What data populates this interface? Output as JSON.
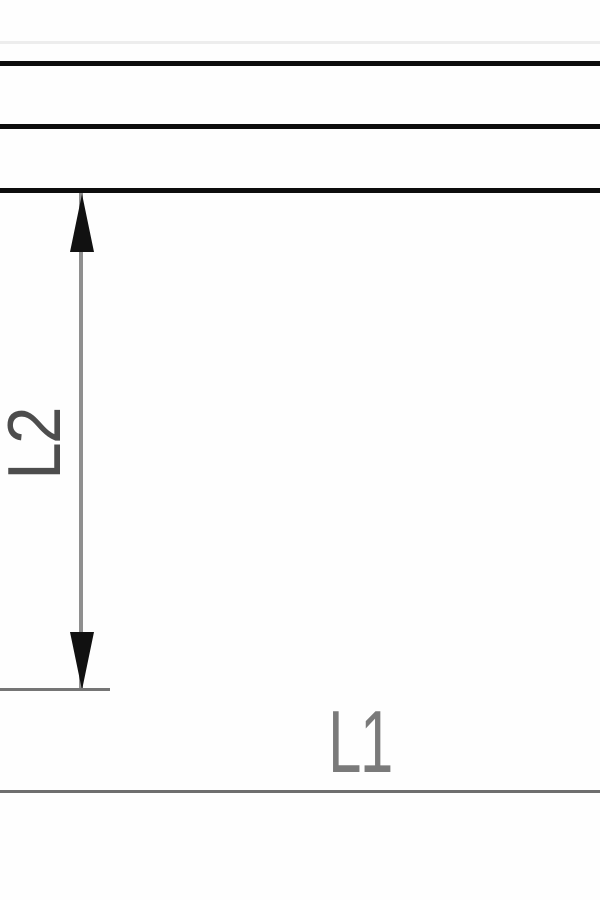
{
  "diagram": {
    "type": "technical-drawing-crop",
    "labels": {
      "vertical_dimension": "L2",
      "horizontal_dimension": "L1"
    },
    "colors": {
      "background": "#fefefe",
      "line_black": "#0d0d0d",
      "line_gray": "#8f8f8f",
      "faint_line": "#ededed",
      "arrow": "#111111",
      "label_l2": "#4d4d4d",
      "label_l1": "#7a7a7a",
      "ext_gray": "#757575",
      "bottom_gray": "#6e6e6e"
    }
  }
}
